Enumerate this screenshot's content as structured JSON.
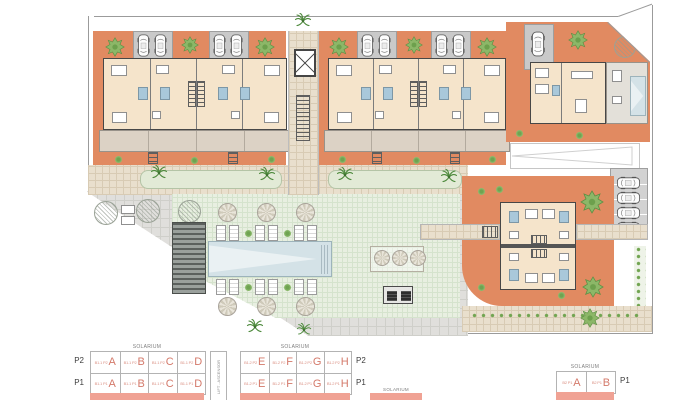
{
  "title": "residential development site plan",
  "colors": {
    "garden": "#e18a61",
    "floor": "#f5e4cb",
    "wall": "#474747",
    "drive": "#c9c9c9",
    "terrace": "#dcd2c5",
    "tile": "#e9dfcd",
    "tile-line": "#d8cbb4",
    "paving": "#e0dfdc",
    "paving-line": "#cfcfca",
    "lawn": "#e8efe1",
    "lawn-line": "#d5e3cd",
    "pool": "#d4e2e7",
    "pool-edge": "#9db3bb",
    "bath": "#a9c8da",
    "accent": "#d4796a",
    "accent-soft": "#db9184",
    "bar": "#f0a294",
    "boundary": "#9b9b9b"
  },
  "legend": {
    "solarium": "SOLARIUM",
    "lift": "LIFT - ASCENSOR",
    "p1": "P1",
    "p2": "P2",
    "table_b11": {
      "rows": [
        {
          "cells": [
            {
              "code": "B1.1 P2",
              "letter": "A"
            },
            {
              "code": "B1.1 P2",
              "letter": "B"
            },
            {
              "code": "B1.1 P2",
              "letter": "C"
            },
            {
              "code": "B1.1 P2",
              "letter": "D"
            }
          ]
        },
        {
          "cells": [
            {
              "code": "B1.1 P1",
              "letter": "A"
            },
            {
              "code": "B1.1 P1",
              "letter": "B"
            },
            {
              "code": "B1.1 P1",
              "letter": "C"
            },
            {
              "code": "B1.1 P1",
              "letter": "D"
            }
          ]
        }
      ]
    },
    "table_b12": {
      "rows": [
        {
          "cells": [
            {
              "code": "B1.2 P2",
              "letter": "E"
            },
            {
              "code": "B1.2 P2",
              "letter": "F"
            },
            {
              "code": "B1.2 P2",
              "letter": "G"
            },
            {
              "code": "B1.2 P2",
              "letter": "H"
            }
          ]
        },
        {
          "cells": [
            {
              "code": "B1.2 P1",
              "letter": "E"
            },
            {
              "code": "B1.2 P1",
              "letter": "F"
            },
            {
              "code": "B1.2 P1",
              "letter": "G"
            },
            {
              "code": "B1.2 P1",
              "letter": "H"
            }
          ]
        }
      ]
    },
    "table_b2": {
      "rows": [
        {
          "cells": [
            {
              "code": "B2 P1",
              "letter": "A"
            },
            {
              "code": "B2 P1",
              "letter": "B"
            }
          ]
        }
      ]
    }
  }
}
